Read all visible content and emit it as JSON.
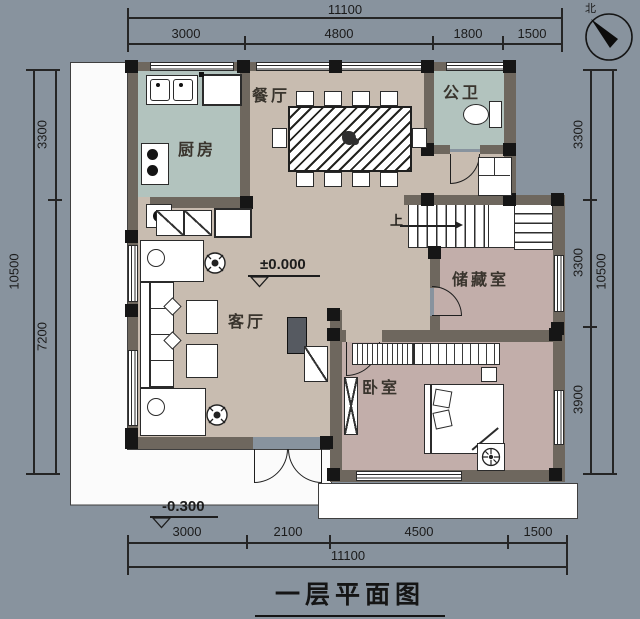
{
  "title": {
    "text": "一层平面图"
  },
  "north": {
    "label": "北"
  },
  "dims": {
    "top": {
      "total": "11100",
      "segments": [
        "3000",
        "4800",
        "1800",
        "1500"
      ]
    },
    "bottom": {
      "total": "11100",
      "segments": [
        "3000",
        "2100",
        "4500",
        "1500"
      ]
    },
    "left": {
      "total": "10500",
      "segments": [
        "3300",
        "7200"
      ]
    },
    "right": {
      "total": "10500",
      "segments": [
        "3300",
        "3300",
        "3900"
      ]
    }
  },
  "rooms": {
    "dining": {
      "label": "餐厅"
    },
    "bath": {
      "label": "公卫"
    },
    "kitchen": {
      "label": "厨房"
    },
    "storage": {
      "label": "储藏室"
    },
    "living": {
      "label": "客厅"
    },
    "bedroom": {
      "label": "卧室"
    }
  },
  "annotations": {
    "stairs_up": "上",
    "level_main": "±0.000",
    "level_porch": "-0.300"
  },
  "colors": {
    "background": "#88939e",
    "floor_living_dining": "#c8bcb0",
    "floor_kitchen_bath": "#b2c3be",
    "floor_storage_bedroom": "#c2aeaa",
    "wall": "#6e675e",
    "column": "#161616",
    "porch": "#ffffff"
  }
}
